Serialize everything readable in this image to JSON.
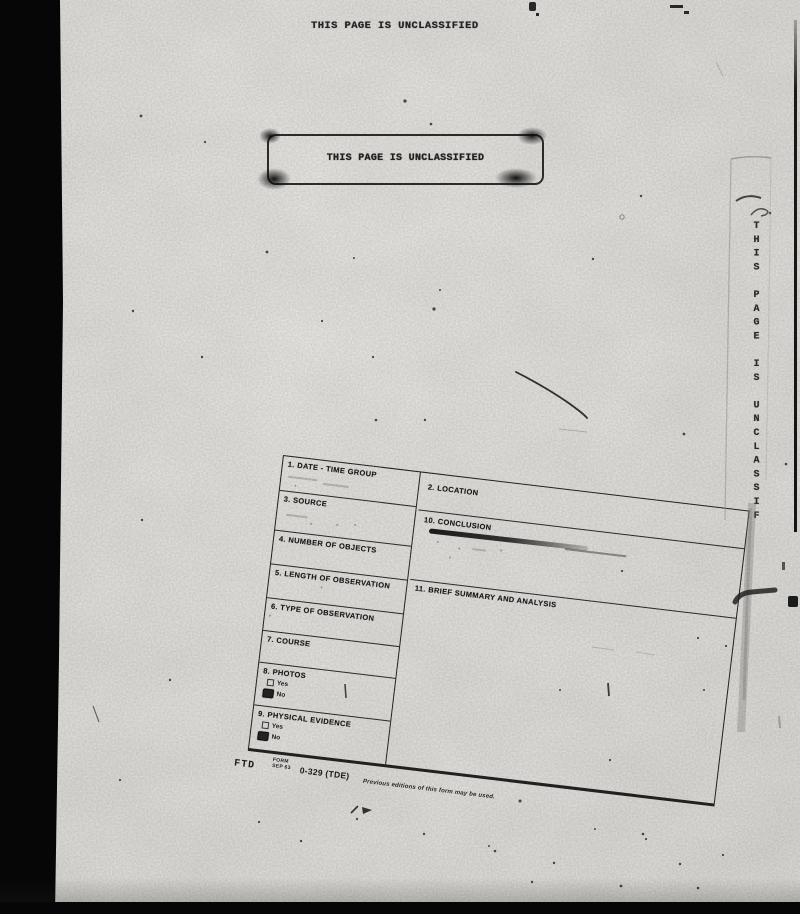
{
  "document": {
    "classification_top": "THIS PAGE IS UNCLASSIFIED",
    "classification_stamp": "THIS PAGE IS UNCLASSIFIED",
    "classification_side_vertical": "THIS PAGE IS UNCLASSIF"
  },
  "form": {
    "fields": {
      "date_time_group": "1. DATE - TIME GROUP",
      "location": "2. LOCATION",
      "source": "3. SOURCE",
      "number_of_objects": "4. NUMBER OF OBJECTS",
      "length_of_observation": "5. LENGTH OF OBSERVATION",
      "type_of_observation": "6. TYPE OF OBSERVATION",
      "course": "7. COURSE",
      "photos": "8. PHOTOS",
      "physical_evidence": "9. PHYSICAL EVIDENCE",
      "conclusion": "10. CONCLUSION",
      "brief_summary_and_analysis": "11. BRIEF SUMMARY AND ANALYSIS"
    },
    "checkboxes": {
      "yes_label": "Yes",
      "no_label": "No",
      "photos": {
        "yes": false,
        "no": true
      },
      "physical_evidence": {
        "yes": false,
        "no": true
      }
    },
    "footer": {
      "org": "FTD",
      "form_label": "FORM",
      "form_date": "SEP 63",
      "form_number": "0-329 (TDE)",
      "note": "Previous editions of this form may be used."
    }
  },
  "colors": {
    "paper": "#e9e8e5",
    "ink": "#1c1c1c",
    "scan_black": "#060606"
  }
}
